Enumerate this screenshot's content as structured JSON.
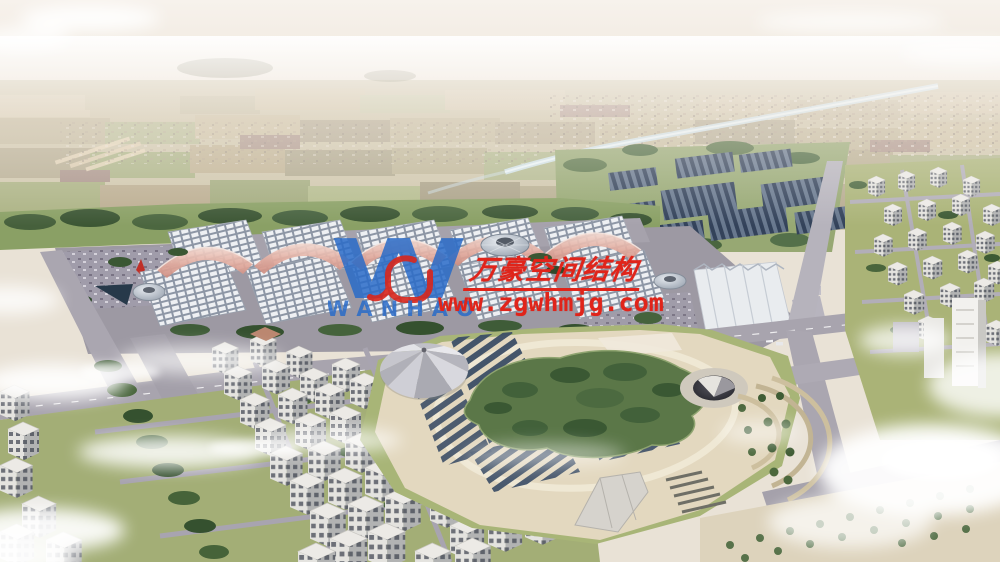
{
  "meta": {
    "subject": "aerial architectural rendering of an exhibition center complex with vaulted halls, solar farm, landscaped park with lake island, and surrounding residential districts"
  },
  "watermark": {
    "logo_letter": "W",
    "logo_text": "WANHAO",
    "company_zh": "万豪空间结构",
    "website": "www.zgwhmjg.com",
    "red": "#e0241a",
    "blue": "#2a6cc8"
  },
  "palette": {
    "sky_haze": "#f4efe8",
    "field_tan": "#cdc3a6",
    "grass_green": "#a7b377",
    "tree_green": "#47613b",
    "road_gray": "#a5a1ab",
    "roof_grid": "#eef0f3",
    "membrane_pink": "#dfa496",
    "solar_panel": "#41546e",
    "park_sand": "#e2d7bd",
    "cloud_white": "#ffffff"
  }
}
